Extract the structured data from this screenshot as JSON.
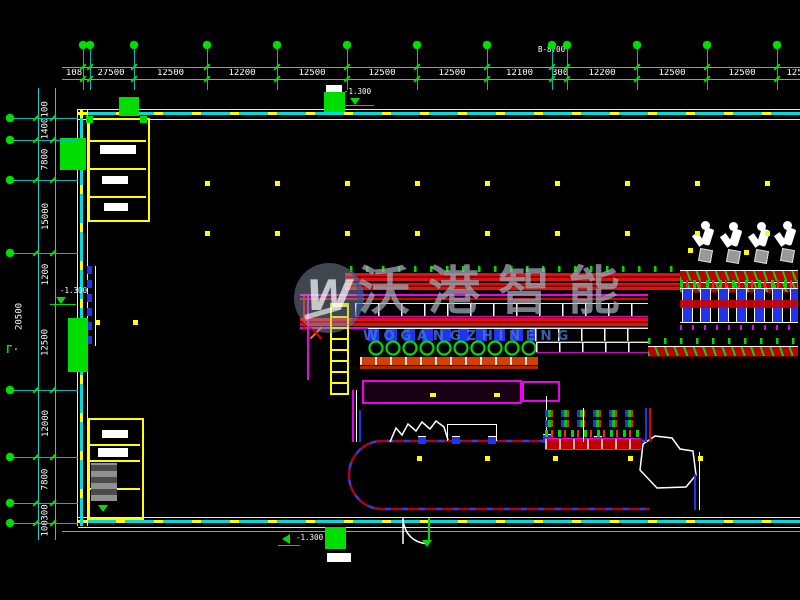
{
  "watermark": {
    "logo_letter": "W",
    "title": "沃港智能",
    "subtitle": "WOGANGZHINENG",
    "title_color": "#a0aab6",
    "subtitle_color": "#4276d6"
  },
  "annotations": {
    "section_label": "B-8700",
    "elevation_top": "-1.300",
    "elevation_left": "-1.300",
    "elevation_bottom": "-1.300",
    "corner_symbol": "Γ·",
    "overall_left_dim": "20500"
  },
  "dimensions": {
    "top": [
      {
        "x0": 60,
        "x1": 88,
        "label": "108"
      },
      {
        "x0": 88,
        "x1": 134,
        "label": "27500"
      },
      {
        "x0": 134,
        "x1": 207,
        "label": "12500"
      },
      {
        "x0": 207,
        "x1": 277,
        "label": "12200"
      },
      {
        "x0": 277,
        "x1": 347,
        "label": "12500"
      },
      {
        "x0": 347,
        "x1": 417,
        "label": "12500"
      },
      {
        "x0": 417,
        "x1": 487,
        "label": "12500"
      },
      {
        "x0": 487,
        "x1": 552,
        "label": "12100"
      },
      {
        "x0": 552,
        "x1": 567,
        "label": "300"
      },
      {
        "x0": 567,
        "x1": 637,
        "label": "12200"
      },
      {
        "x0": 637,
        "x1": 707,
        "label": "12500"
      },
      {
        "x0": 707,
        "x1": 777,
        "label": "12500"
      },
      {
        "x0": 777,
        "x1": 812,
        "label": "125"
      }
    ],
    "left": [
      {
        "y0": 104,
        "y1": 118,
        "label": "100"
      },
      {
        "y0": 118,
        "y1": 140,
        "label": "1400"
      },
      {
        "y0": 140,
        "y1": 180,
        "label": "7800"
      },
      {
        "y0": 180,
        "y1": 253,
        "label": "15000"
      },
      {
        "y0": 253,
        "y1": 296,
        "label": "1200"
      },
      {
        "y0": 296,
        "y1": 390,
        "label": "12500"
      },
      {
        "y0": 390,
        "y1": 457,
        "label": "12000"
      },
      {
        "y0": 457,
        "y1": 503,
        "label": "7800"
      },
      {
        "y0": 503,
        "y1": 523,
        "label": "300"
      },
      {
        "y0": 523,
        "y1": 537,
        "label": "100"
      }
    ]
  },
  "axes": {
    "top_x": [
      83,
      90,
      134,
      207,
      277,
      347,
      417,
      487,
      552,
      567,
      637,
      707,
      777
    ],
    "left_y": [
      118,
      140,
      180,
      253,
      390,
      457,
      503,
      523
    ]
  },
  "grid": {
    "dot_rows": [
      {
        "x": 205,
        "y": 181,
        "w": 565
      },
      {
        "x": 205,
        "y": 231,
        "w": 565
      }
    ],
    "extra_dots": [
      [
        95,
        320
      ],
      [
        133,
        320
      ],
      [
        417,
        456
      ],
      [
        485,
        456
      ],
      [
        553,
        456
      ],
      [
        628,
        456
      ],
      [
        698,
        456
      ],
      [
        688,
        248
      ],
      [
        744,
        250
      ]
    ]
  },
  "colors": {
    "background": "#000000",
    "dimension_line": "#00d8d8",
    "axis_bubble": "#00e000",
    "wall_dash_yellow": "#ffff00",
    "wall_dash_cyan": "#00dcdc",
    "room_outline": "#ffff00",
    "column_green": "#00dd00",
    "conveyor_red": "#c80000",
    "conveyor_orange": "#d44000",
    "conveyor_magenta": "#ee00ee",
    "equipment_blue": "#2233ee",
    "loop_red": "#aa0028",
    "loop_blue": "#2244ff",
    "white": "#ffffff"
  }
}
